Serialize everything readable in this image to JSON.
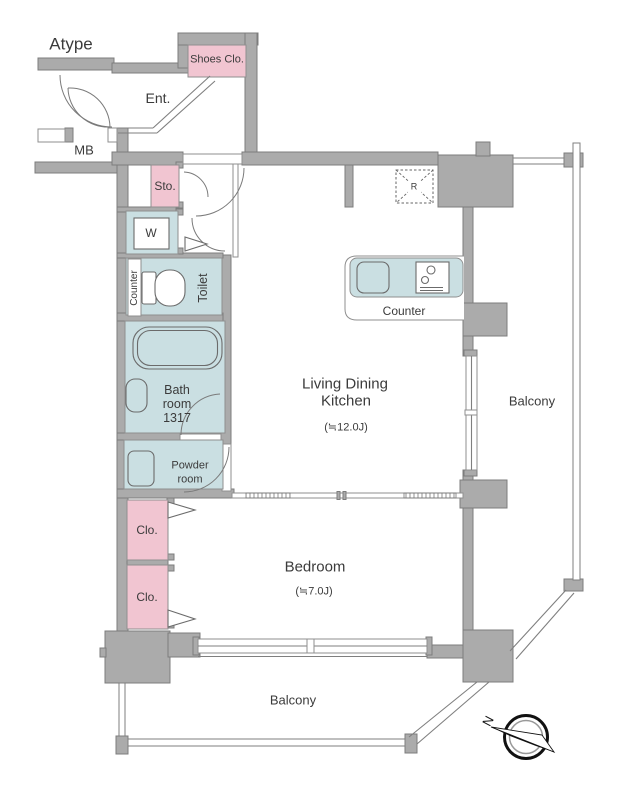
{
  "plan": {
    "type": "Atype"
  },
  "colors": {
    "wall_fill": "#ababab",
    "wall_stroke": "#7d7d7d",
    "room_pink": "#f1c5d1",
    "room_blue": "#cadfe2",
    "line": "#6b6b6b",
    "text": "#3b3b3b"
  },
  "rooms": {
    "entrance": {
      "label": "Ent."
    },
    "shoes_closet": {
      "label": "Shoes Clo."
    },
    "meter_box": {
      "label": "MB"
    },
    "storage": {
      "label": "Sto."
    },
    "washer": {
      "label": "W"
    },
    "toilet": {
      "label": "Toilet",
      "counter_label": "Counter"
    },
    "bathroom": {
      "lines": [
        "Bath",
        "room",
        "1317"
      ]
    },
    "powder_room": {
      "lines": [
        "Powder",
        "room"
      ]
    },
    "ldk": {
      "name_line1": "Living Dining",
      "name_line2": "Kitchen",
      "size": "(≒12.0J)"
    },
    "kitchen": {
      "counter_label": "Counter",
      "fridge_label": "R"
    },
    "bedroom": {
      "label": "Bedroom",
      "size": "(≒7.0J)"
    },
    "closet_upper": {
      "label": "Clo."
    },
    "closet_lower": {
      "label": "Clo."
    },
    "balcony_right": {
      "label": "Balcony"
    },
    "balcony_bottom": {
      "label": "Balcony"
    }
  },
  "compass": {
    "north": "N"
  }
}
